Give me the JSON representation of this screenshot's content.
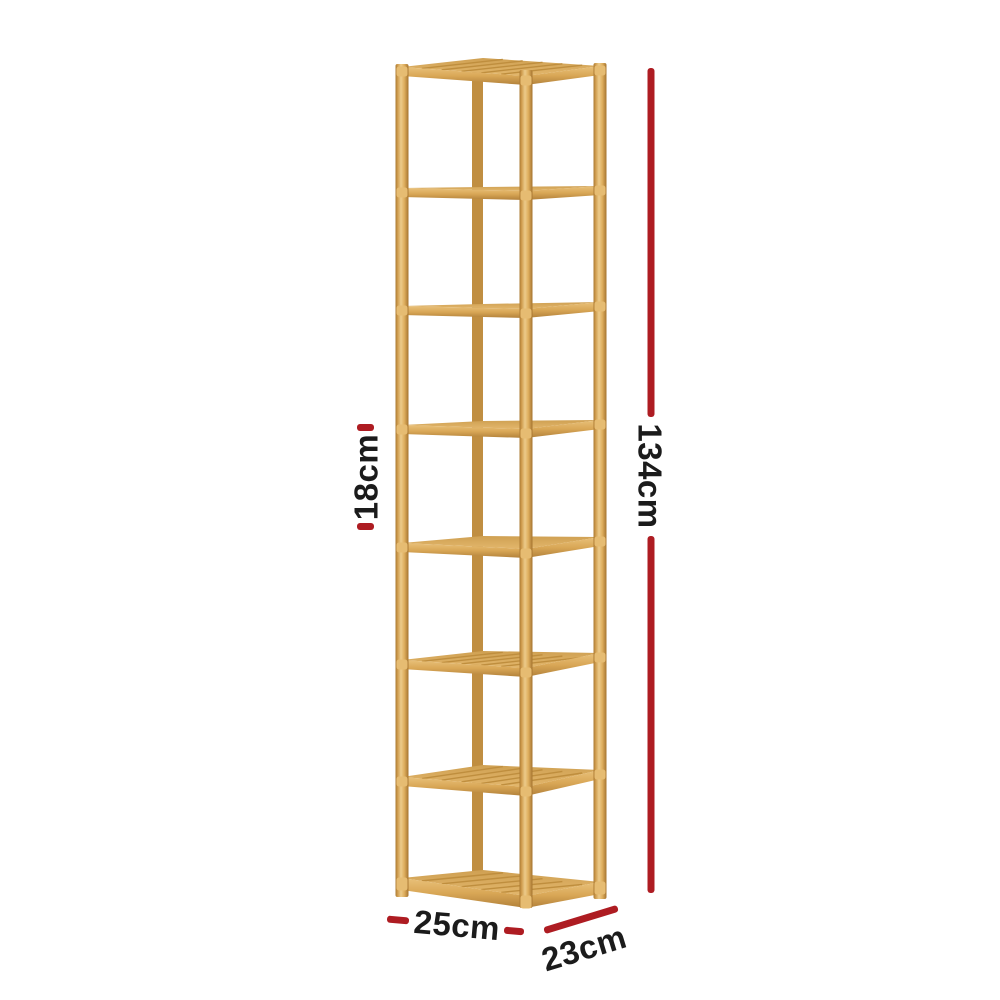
{
  "image": {
    "description": "Product dimension diagram of a tall 8-tier wooden corner shelf on a white background",
    "background": "#FFFFFF"
  },
  "product": {
    "name": "8-tier wooden corner shelf",
    "tier_count": 8,
    "wood_color": "#DCA95B"
  },
  "annotation": {
    "accent_color": "#AE1C22",
    "text_color": "#1B1B1B"
  },
  "dimensions": {
    "height": "134cm",
    "tier_spacing": "18cm",
    "width": "25cm",
    "depth": "23cm"
  }
}
